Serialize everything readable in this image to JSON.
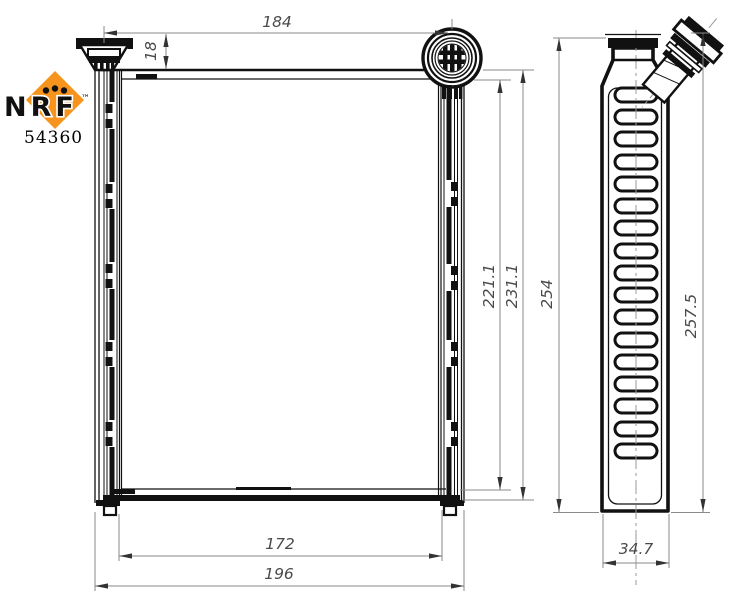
{
  "drawing": {
    "brand": "NRF",
    "trademark": "™",
    "part_number": "54360",
    "colors": {
      "accent_orange": "#F7941D",
      "line_black": "#111111",
      "dimension_gray": "#8a8a8a",
      "dimension_text_gray": "#4a4a4a"
    },
    "dimensions": {
      "top_width": "184",
      "inlet_height": "18",
      "core_height": "221.1",
      "overall_height": "231.1",
      "side_height": "254",
      "side_overall_height": "257.5",
      "core_width": "172",
      "overall_width": "196",
      "depth": "34.7"
    }
  }
}
